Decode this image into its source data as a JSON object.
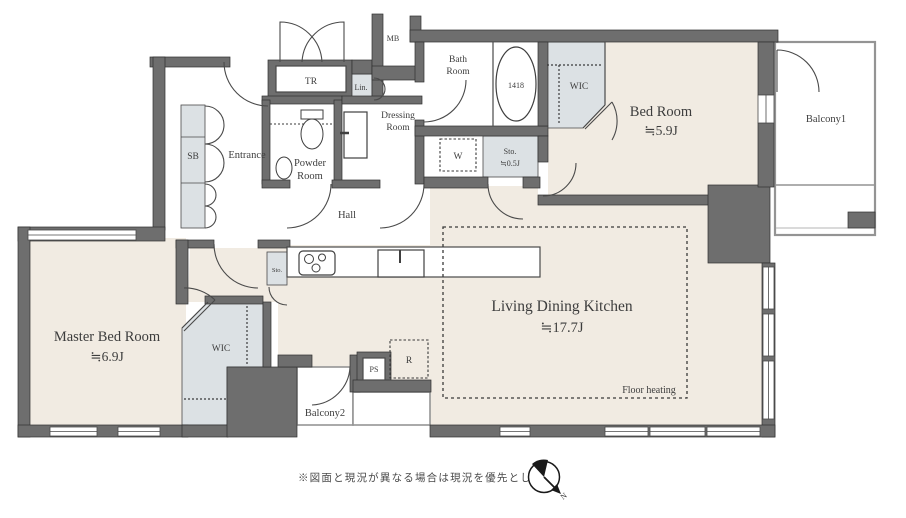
{
  "plan": {
    "rooms": {
      "bedroom": {
        "label": "Bed Room",
        "area": "≒5.9J"
      },
      "master_bedroom": {
        "label": "Master Bed Room",
        "area": "≒6.9J"
      },
      "ldk": {
        "label": "Living Dining Kitchen",
        "area": "≒17.7J",
        "note": "Floor heating"
      },
      "hall": {
        "label": "Hall"
      },
      "entrance": {
        "label": "Entrance"
      },
      "bath": {
        "line1": "Bath",
        "line2": "Room",
        "tub_size": "1418"
      },
      "powder": {
        "line1": "Powder",
        "line2": "Room"
      },
      "dressing": {
        "line1": "Dressing",
        "line2": "Room"
      },
      "wic_upper": {
        "label": "WIC"
      },
      "wic_master": {
        "label": "WIC"
      },
      "balcony1": {
        "label": "Balcony1"
      },
      "balcony2": {
        "label": "Balcony2"
      },
      "storage_small": {
        "label": "Sto.",
        "area": "≒0.5J"
      },
      "storage_kitchen": {
        "label": "Sto."
      }
    },
    "closets": {
      "sb": "SB",
      "tr": "TR",
      "mb": "MB",
      "lin": "Lin."
    },
    "fixtures": {
      "washer": "W",
      "ps": "PS",
      "fridge": "R"
    }
  },
  "footer": {
    "disclaimer": "※図面と現況が異なる場合は現況を優先とします。",
    "compass_n": "N"
  },
  "colors": {
    "wall": "#6e6e6e",
    "floor": "#f1ebe2",
    "closet": "#dce1e4"
  }
}
